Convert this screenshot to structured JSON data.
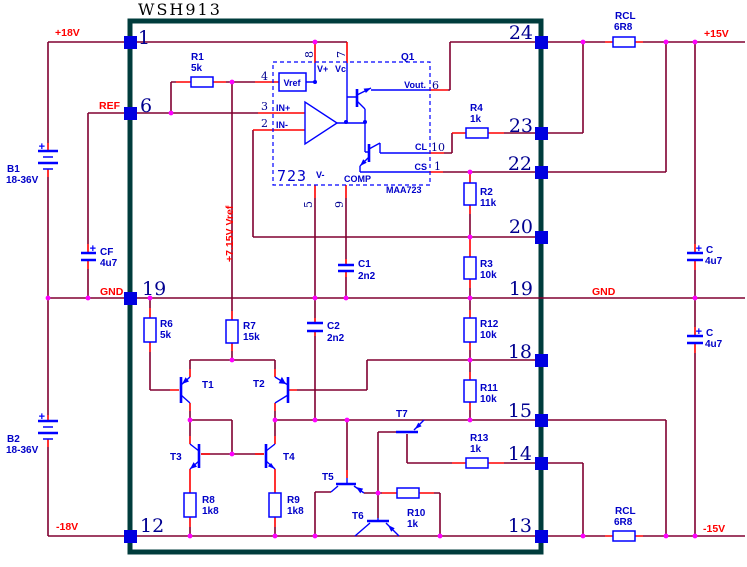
{
  "title": "WSH913",
  "colors": {
    "background": "#FFFFFF",
    "wire": "#800030",
    "lead": "#FF0000",
    "junction": "#FF00FF",
    "symbol": "#0000FF",
    "label": "#0000C8",
    "pin_square": "#0000E0",
    "number": "#000090",
    "border": "#003C3C",
    "net": "#FF0000",
    "title": "#000000"
  },
  "nets": {
    "plus18": "+18V",
    "ref": "REF",
    "gnd_left": "GND",
    "minus18": "-18V",
    "plus15": "+15V",
    "minus15": "-15V",
    "gnd_right": "GND",
    "vref_rail": "+7.15V Vref"
  },
  "module": {
    "name": "WSH913",
    "pins_left": [
      "1",
      "6",
      "19",
      "12"
    ],
    "pins_right": [
      "24",
      "23",
      "22",
      "20",
      "19",
      "18",
      "15",
      "14",
      "13"
    ]
  },
  "regulator": {
    "designator": "Q1",
    "core": "723",
    "part": "MAA723",
    "labels": {
      "vref": "Vref",
      "vplus": "V+",
      "vc": "Vc",
      "inp": "IN+",
      "inn": "IN-",
      "vminus": "V-",
      "comp": "COMP",
      "vout": "Vout.",
      "cl": "CL",
      "cs": "CS"
    },
    "pins": {
      "vref": "4",
      "inp": "3",
      "inn": "2",
      "vplus": "8",
      "vc": "7",
      "vout": "6",
      "cl": "10",
      "cs": "1",
      "vminus": "5",
      "comp": "9"
    }
  },
  "parts": {
    "R1": {
      "ref": "R1",
      "value": "5k"
    },
    "R2": {
      "ref": "R2",
      "value": "11k"
    },
    "R3": {
      "ref": "R3",
      "value": "10k"
    },
    "R4": {
      "ref": "R4",
      "value": "1k"
    },
    "R6": {
      "ref": "R6",
      "value": "5k"
    },
    "R7": {
      "ref": "R7",
      "value": "15k"
    },
    "R8": {
      "ref": "R8",
      "value": "1k8"
    },
    "R9": {
      "ref": "R9",
      "value": "1k8"
    },
    "R10": {
      "ref": "R10",
      "value": "1k"
    },
    "R11": {
      "ref": "R11",
      "value": "10k"
    },
    "R12": {
      "ref": "R12",
      "value": "10k"
    },
    "R13": {
      "ref": "R13",
      "value": "1k"
    },
    "RCL_TOP": {
      "ref": "RCL",
      "value": "6R8"
    },
    "RCL_BOT": {
      "ref": "RCL",
      "value": "6R8"
    },
    "C1": {
      "ref": "C1",
      "value": "2n2"
    },
    "C2": {
      "ref": "C2",
      "value": "2n2"
    },
    "CF": {
      "ref": "CF",
      "value": "4u7"
    },
    "C_TOP": {
      "ref": "C",
      "value": "4u7"
    },
    "C_BOT": {
      "ref": "C",
      "value": "4u7"
    },
    "B1": {
      "ref": "B1",
      "value": "18-36V"
    },
    "B2": {
      "ref": "B2",
      "value": "18-36V"
    },
    "T1": {
      "ref": "T1"
    },
    "T2": {
      "ref": "T2"
    },
    "T3": {
      "ref": "T3"
    },
    "T4": {
      "ref": "T4"
    },
    "T5": {
      "ref": "T5"
    },
    "T6": {
      "ref": "T6"
    },
    "T7": {
      "ref": "T7"
    }
  },
  "symbols": {
    "plus": "+"
  }
}
